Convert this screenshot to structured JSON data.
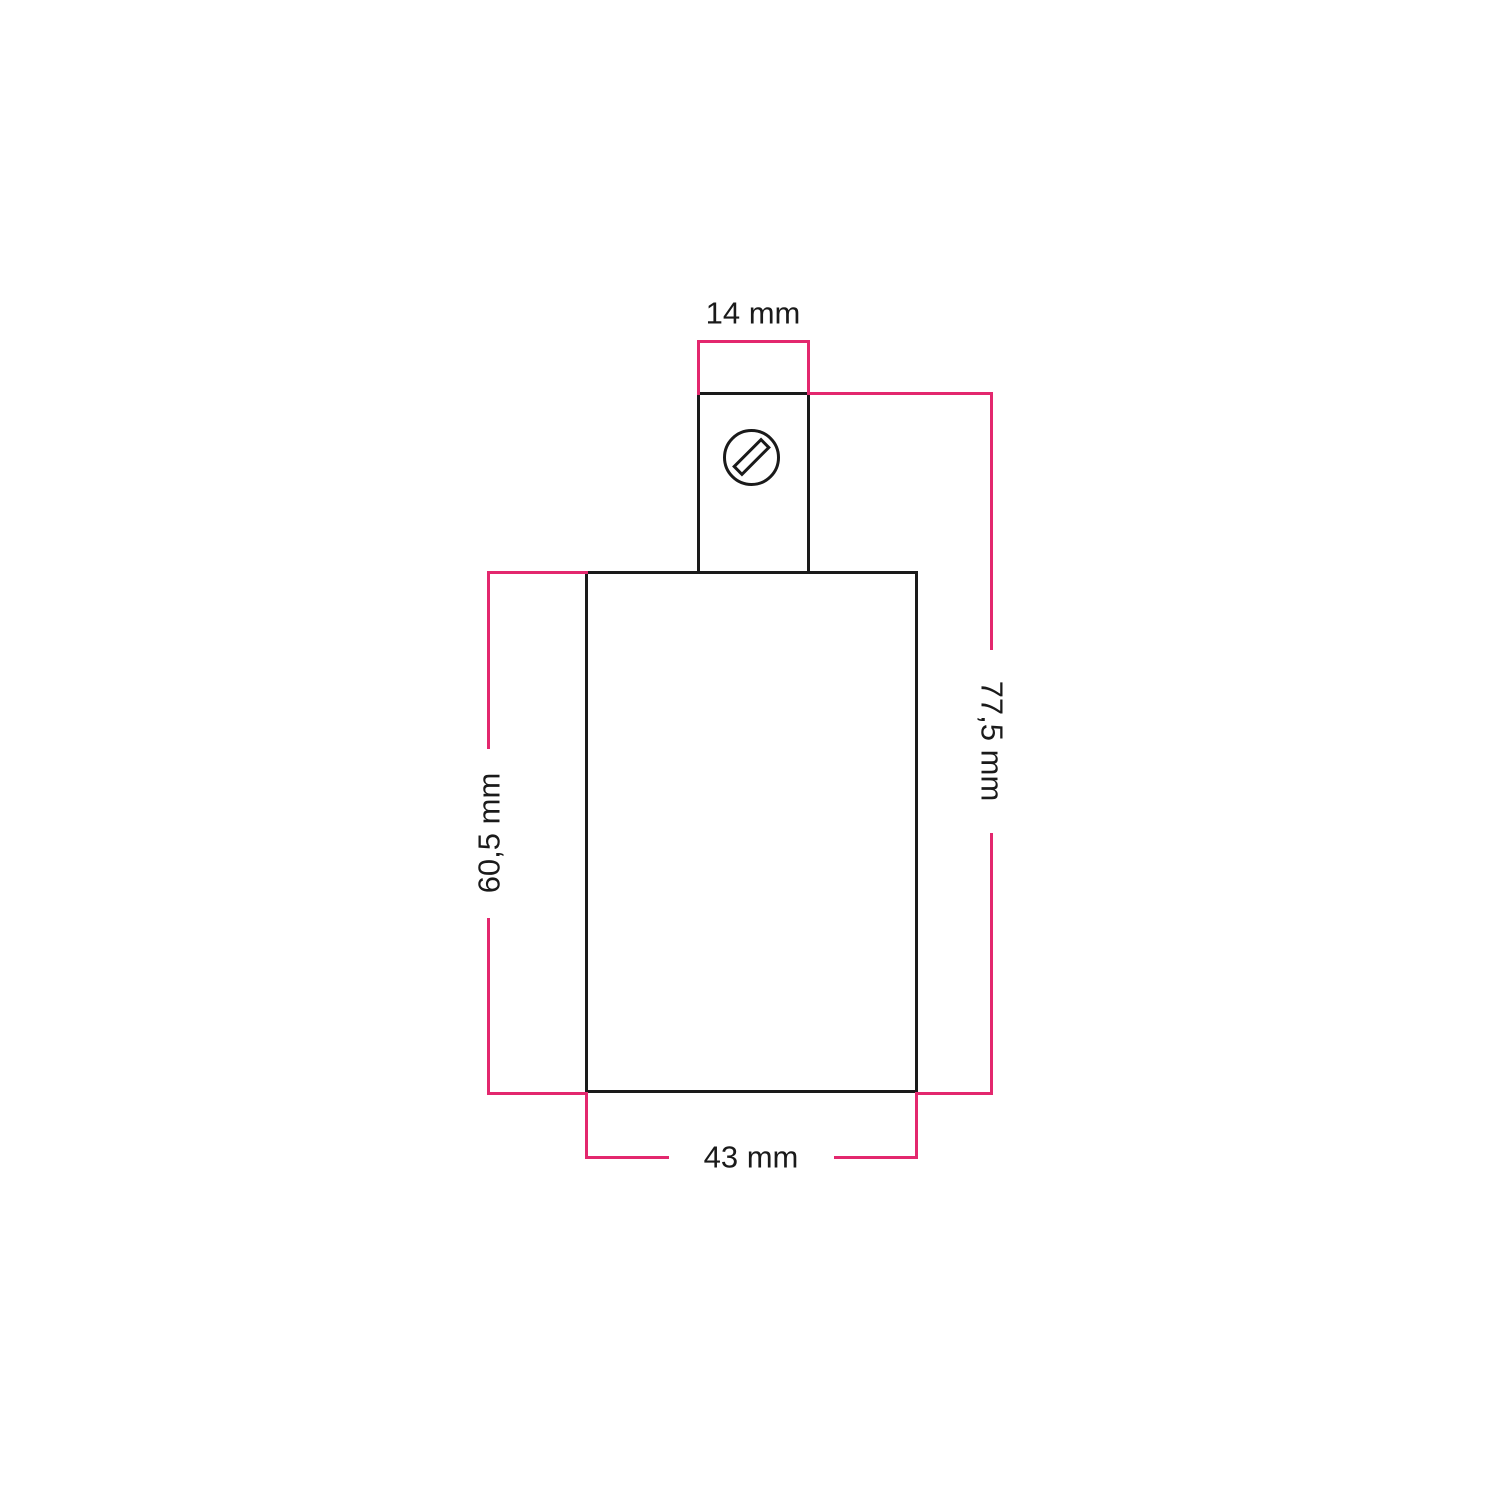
{
  "diagram": {
    "labels": {
      "clamp_width": "14 mm",
      "total_height": "77,5 mm",
      "body_height": "60,5 mm",
      "body_width": "43 mm"
    },
    "colors": {
      "dimension_line": "#e3286e",
      "outline": "#1a1a1a",
      "background": "#ffffff"
    },
    "icons": {
      "screw": "slotted-screw-head-icon"
    }
  }
}
